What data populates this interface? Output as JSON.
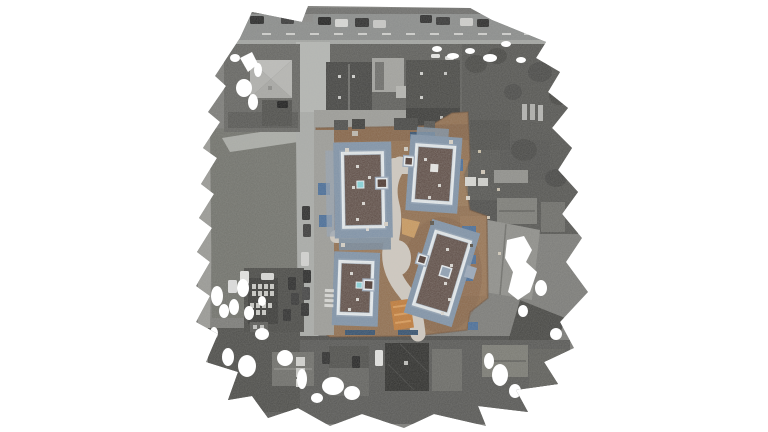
{
  "scene": {
    "kind": "aerial-orthomosaic-photo",
    "background": "#ffffff"
  },
  "colors": {
    "ground_gray": "#7c7c79",
    "left_band": "#9a9a96",
    "grass": "#72736d",
    "grass_path": "#aaaca7",
    "top_road": "#8b8d8c",
    "sidewalk": "#a3a5a2",
    "vertical_road": "#a9aba8",
    "bottom_road": "#8d8f8d",
    "diag_road": "#999b98",
    "dark_yard": "#4e4e4b",
    "backyard_dark": "#565653",
    "bottom_base": "#585856",
    "light_roof": "#b4b4b1",
    "dark_roof1": "#454543",
    "dark_roof2": "#4a4a47",
    "dark_roof3": "#3c3c3a",
    "diamond_roof": "#30302e",
    "site_dirt": "#916f50",
    "site_dirt_light": "#a5825f",
    "site_dirt_dark": "#7b5b42",
    "site_path": "#cfc9c0",
    "site_pavement": "#9c9c98",
    "building_roof": "#4e3a33",
    "building_scaffold": "#8093a8",
    "building_scaffold_light": "#9aa8ba",
    "building_parapet": "#e8eef2",
    "skylight_cyan": "#86d2d8",
    "material_blue": "#4a6e99",
    "material_blue_dark": "#35516f",
    "orange_patch": "#c07b3a",
    "tan_patch": "#c9995f",
    "hole_white": "#ffffff"
  },
  "vehicles": {
    "top_road": [
      {
        "x": 250,
        "y": 16,
        "w": 14,
        "h": 8,
        "c": "#2a2a2a"
      },
      {
        "x": 281,
        "y": 16,
        "w": 13,
        "h": 8,
        "c": "#3a3a3a"
      },
      {
        "x": 300,
        "y": 14,
        "w": 13,
        "h": 8,
        "c": "#8a8a88"
      },
      {
        "x": 318,
        "y": 17,
        "w": 13,
        "h": 8,
        "c": "#242424"
      },
      {
        "x": 335,
        "y": 19,
        "w": 13,
        "h": 8,
        "c": "#d8d8d6"
      },
      {
        "x": 355,
        "y": 18,
        "w": 14,
        "h": 9,
        "c": "#303030"
      },
      {
        "x": 373,
        "y": 20,
        "w": 13,
        "h": 8,
        "c": "#c8c8c6"
      },
      {
        "x": 420,
        "y": 15,
        "w": 12,
        "h": 8,
        "c": "#2e2e2e"
      },
      {
        "x": 436,
        "y": 17,
        "w": 14,
        "h": 8,
        "c": "#383838"
      },
      {
        "x": 460,
        "y": 18,
        "w": 13,
        "h": 8,
        "c": "#cfcfcd"
      },
      {
        "x": 477,
        "y": 19,
        "w": 12,
        "h": 8,
        "c": "#2c2c2c"
      }
    ],
    "streets": [
      {
        "x": 302,
        "y": 206,
        "w": 8,
        "h": 14,
        "c": "#2e2e2e"
      },
      {
        "x": 303,
        "y": 224,
        "w": 8,
        "h": 13,
        "c": "#3c3c3c"
      },
      {
        "x": 301,
        "y": 252,
        "w": 8,
        "h": 14,
        "c": "#d2d2d0"
      },
      {
        "x": 303,
        "y": 270,
        "w": 8,
        "h": 13,
        "c": "#2a2a2a"
      },
      {
        "x": 302,
        "y": 287,
        "w": 8,
        "h": 13,
        "c": "#444444"
      },
      {
        "x": 301,
        "y": 303,
        "w": 8,
        "h": 13,
        "c": "#303030"
      },
      {
        "x": 277,
        "y": 101,
        "w": 11,
        "h": 7,
        "c": "#1e1e1e"
      },
      {
        "x": 375,
        "y": 350,
        "w": 8,
        "h": 16,
        "c": "#e2e2e0"
      },
      {
        "x": 352,
        "y": 356,
        "w": 8,
        "h": 12,
        "c": "#262626"
      },
      {
        "x": 322,
        "y": 352,
        "w": 8,
        "h": 12,
        "c": "#2e2e2e"
      },
      {
        "x": 288,
        "y": 277,
        "w": 8,
        "h": 13,
        "c": "#2c2c2c"
      },
      {
        "x": 291,
        "y": 293,
        "w": 8,
        "h": 12,
        "c": "#383838"
      },
      {
        "x": 283,
        "y": 309,
        "w": 8,
        "h": 12,
        "c": "#303030"
      },
      {
        "x": 228,
        "y": 280,
        "w": 9,
        "h": 13,
        "c": "#dedede"
      },
      {
        "x": 240,
        "y": 271,
        "w": 9,
        "h": 13,
        "c": "#e4e4e2"
      },
      {
        "x": 261,
        "y": 273,
        "w": 13,
        "h": 7,
        "c": "#d8d8d6"
      },
      {
        "x": 431,
        "y": 54,
        "w": 9,
        "h": 4,
        "c": "#e8e8e6"
      },
      {
        "x": 445,
        "y": 56,
        "w": 9,
        "h": 4,
        "c": "#dcdcda"
      }
    ]
  },
  "road_dashes": [
    {
      "x": 262,
      "y": 33
    },
    {
      "x": 286,
      "y": 33
    },
    {
      "x": 310,
      "y": 33
    },
    {
      "x": 334,
      "y": 33
    },
    {
      "x": 358,
      "y": 33
    },
    {
      "x": 382,
      "y": 33
    },
    {
      "x": 406,
      "y": 33
    },
    {
      "x": 430,
      "y": 33
    },
    {
      "x": 454,
      "y": 33
    },
    {
      "x": 478,
      "y": 33
    },
    {
      "x": 502,
      "y": 33
    },
    {
      "x": 524,
      "y": 33
    }
  ],
  "site": {
    "containers": [
      {
        "x": 334,
        "y": 120,
        "w": 14,
        "h": 10,
        "c": "#4e4e4c"
      },
      {
        "x": 352,
        "y": 119,
        "w": 13,
        "h": 10,
        "c": "#3e3e3c"
      },
      {
        "x": 394,
        "y": 118,
        "w": 24,
        "h": 12,
        "c": "#474745"
      },
      {
        "x": 424,
        "y": 121,
        "w": 11,
        "h": 8,
        "c": "#535351"
      }
    ],
    "material_stacks": [
      {
        "x": 318,
        "y": 183,
        "w": 12,
        "h": 12
      },
      {
        "x": 319,
        "y": 215,
        "w": 13,
        "h": 12
      },
      {
        "x": 455,
        "y": 159,
        "w": 8,
        "h": 12
      },
      {
        "x": 462,
        "y": 226,
        "w": 14,
        "h": 9
      },
      {
        "x": 465,
        "y": 255,
        "w": 11,
        "h": 9
      },
      {
        "x": 461,
        "y": 272,
        "w": 12,
        "h": 9
      },
      {
        "x": 468,
        "y": 322,
        "w": 10,
        "h": 8
      },
      {
        "x": 345,
        "y": 330,
        "w": 30,
        "h": 5,
        "c": "#35516f"
      },
      {
        "x": 398,
        "y": 330,
        "w": 20,
        "h": 5,
        "c": "#35516f"
      },
      {
        "x": 410,
        "y": 132,
        "w": 25,
        "h": 7,
        "c": "#35516f"
      }
    ],
    "props": [
      {
        "x": 345,
        "y": 148,
        "w": 4,
        "h": 4,
        "c": "#d8d4cc"
      },
      {
        "x": 404,
        "y": 147,
        "w": 4,
        "h": 4,
        "c": "#cfcabf"
      },
      {
        "x": 449,
        "y": 140,
        "w": 4,
        "h": 4,
        "c": "#d5d0c6"
      },
      {
        "x": 478,
        "y": 150,
        "w": 3,
        "h": 3,
        "c": "#cabfa8"
      },
      {
        "x": 481,
        "y": 170,
        "w": 4,
        "h": 4,
        "c": "#d0c7b8"
      },
      {
        "x": 497,
        "y": 188,
        "w": 3,
        "h": 3,
        "c": "#c8bfae"
      },
      {
        "x": 466,
        "y": 196,
        "w": 4,
        "h": 4,
        "c": "#d8d2c8"
      },
      {
        "x": 487,
        "y": 216,
        "w": 3,
        "h": 3,
        "c": "#cdc4b4"
      },
      {
        "x": 341,
        "y": 243,
        "w": 4,
        "h": 4,
        "c": "#d5cfc5"
      },
      {
        "x": 384,
        "y": 222,
        "w": 4,
        "h": 4,
        "c": "#d8d2c8"
      },
      {
        "x": 498,
        "y": 252,
        "w": 3,
        "h": 3,
        "c": "#d2cabb"
      },
      {
        "x": 430,
        "y": 221,
        "w": 4,
        "h": 4,
        "c": "#5a5348"
      },
      {
        "x": 470,
        "y": 244,
        "w": 3,
        "h": 3,
        "c": "#564f44"
      },
      {
        "x": 465,
        "y": 177,
        "w": 11,
        "h": 9,
        "c": "#d8d8d4"
      },
      {
        "x": 478,
        "y": 178,
        "w": 10,
        "h": 8,
        "c": "#cfcfcb"
      },
      {
        "x": 296,
        "y": 357,
        "w": 9,
        "h": 9,
        "c": "#d2d2cf"
      },
      {
        "x": 296,
        "y": 368,
        "w": 9,
        "h": 9,
        "c": "#c9c9c6"
      },
      {
        "x": 296,
        "y": 379,
        "w": 9,
        "h": 8,
        "c": "#d6d6d3"
      },
      {
        "x": 522,
        "y": 104,
        "w": 5,
        "h": 16,
        "c": "#b2b2af"
      },
      {
        "x": 530,
        "y": 104,
        "w": 5,
        "h": 16,
        "c": "#aeaeab"
      },
      {
        "x": 538,
        "y": 105,
        "w": 5,
        "h": 16,
        "c": "#b5b5b2"
      },
      {
        "x": 352,
        "y": 131,
        "w": 6,
        "h": 5,
        "c": "#bdb8ae"
      }
    ],
    "roof_dots": [
      [
        356,
        165
      ],
      [
        368,
        176
      ],
      [
        352,
        186
      ],
      [
        362,
        202
      ],
      [
        356,
        218
      ],
      [
        366,
        228
      ],
      [
        424,
        158
      ],
      [
        438,
        184
      ],
      [
        428,
        196
      ],
      [
        350,
        272
      ],
      [
        356,
        298
      ],
      [
        348,
        308
      ],
      [
        446,
        248
      ],
      [
        450,
        264
      ],
      [
        444,
        282
      ],
      [
        448,
        298
      ],
      [
        441,
        312
      ]
    ]
  },
  "mosaic_holes": [
    {
      "cx": 244,
      "cy": 88,
      "rx": 8,
      "ry": 9
    },
    {
      "pts": "240,58 252,52 258,64 248,72"
    },
    {
      "cx": 253,
      "cy": 102,
      "rx": 5,
      "ry": 8
    },
    {
      "cx": 235,
      "cy": 58,
      "rx": 5,
      "ry": 4
    },
    {
      "cx": 258,
      "cy": 70,
      "rx": 4,
      "ry": 7
    },
    {
      "cx": 437,
      "cy": 49,
      "rx": 5,
      "ry": 3
    },
    {
      "cx": 453,
      "cy": 56,
      "rx": 6,
      "ry": 3
    },
    {
      "cx": 470,
      "cy": 51,
      "rx": 5,
      "ry": 3
    },
    {
      "cx": 490,
      "cy": 58,
      "rx": 7,
      "ry": 4
    },
    {
      "cx": 506,
      "cy": 44,
      "rx": 5,
      "ry": 3
    },
    {
      "cx": 521,
      "cy": 60,
      "rx": 5,
      "ry": 3
    },
    {
      "cx": 217,
      "cy": 296,
      "rx": 6,
      "ry": 10
    },
    {
      "cx": 224,
      "cy": 311,
      "rx": 5,
      "ry": 7
    },
    {
      "cx": 243,
      "cy": 288,
      "rx": 6,
      "ry": 9
    },
    {
      "cx": 234,
      "cy": 307,
      "rx": 5,
      "ry": 8
    },
    {
      "cx": 249,
      "cy": 313,
      "rx": 5,
      "ry": 7
    },
    {
      "cx": 228,
      "cy": 357,
      "rx": 6,
      "ry": 9
    },
    {
      "cx": 247,
      "cy": 366,
      "rx": 9,
      "ry": 11
    },
    {
      "cx": 262,
      "cy": 301,
      "rx": 4,
      "ry": 5
    },
    {
      "cx": 214,
      "cy": 333,
      "rx": 4,
      "ry": 6
    },
    {
      "cx": 262,
      "cy": 334,
      "rx": 7,
      "ry": 6
    },
    {
      "cx": 285,
      "cy": 358,
      "rx": 8,
      "ry": 8
    },
    {
      "cx": 333,
      "cy": 386,
      "rx": 11,
      "ry": 9
    },
    {
      "cx": 352,
      "cy": 393,
      "rx": 8,
      "ry": 7
    },
    {
      "cx": 302,
      "cy": 379,
      "rx": 5,
      "ry": 10
    },
    {
      "cx": 317,
      "cy": 398,
      "rx": 6,
      "ry": 5
    },
    {
      "pts": "507,240 524,236 532,250 526,262 537,272 530,292 518,300 508,292 513,272 505,258"
    },
    {
      "cx": 541,
      "cy": 288,
      "rx": 6,
      "ry": 8
    },
    {
      "cx": 523,
      "cy": 311,
      "rx": 5,
      "ry": 6
    },
    {
      "cx": 500,
      "cy": 375,
      "rx": 8,
      "ry": 11
    },
    {
      "cx": 515,
      "cy": 391,
      "rx": 6,
      "ry": 7
    },
    {
      "cx": 489,
      "cy": 361,
      "rx": 5,
      "ry": 8
    },
    {
      "cx": 556,
      "cy": 334,
      "rx": 6,
      "ry": 6
    }
  ]
}
